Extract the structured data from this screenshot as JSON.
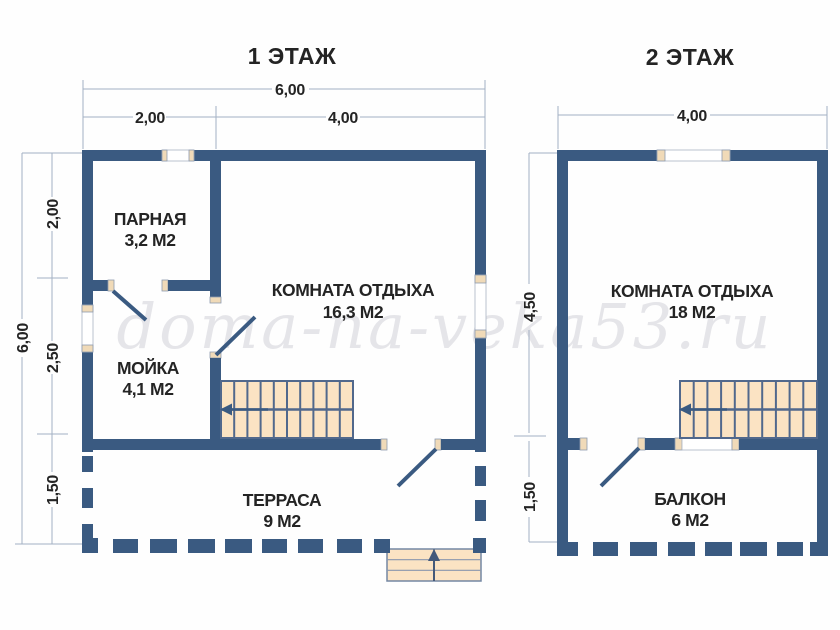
{
  "page": {
    "background": "#fefefe"
  },
  "colors": {
    "wall": "#3a5a81",
    "stair_tread": "#fbe3c3",
    "window_jamb": "#f0dab8",
    "dimension_line": "#a3b0c4",
    "label_text": "#242424",
    "watermark": "#e5e5e9"
  },
  "icons": {
    "stairs_direction": "left-arrow",
    "entrance_direction": "up-arrow"
  },
  "watermark": {
    "text": "doma-na-veka53.ru"
  },
  "floor1": {
    "title": "1 ЭТАЖ",
    "dimensions": {
      "width_total": "6,00",
      "width_left": "2,00",
      "width_right": "4,00",
      "height_total": "6,00",
      "height_top": "2,00",
      "height_middle": "2,50",
      "height_bottom": "1,50"
    },
    "rooms": [
      {
        "name": "ПАРНАЯ",
        "area": "3,2 М2"
      },
      {
        "name": "КОМНАТА ОТДЫХА",
        "area": "16,3 М2"
      },
      {
        "name": "МОЙКА",
        "area": "4,1 М2"
      },
      {
        "name": "ТЕРРАСА",
        "area": "9 М2"
      }
    ]
  },
  "floor2": {
    "title": "2 ЭТАЖ",
    "dimensions": {
      "width_total": "4,00",
      "height_top": "4,50",
      "height_bottom": "1,50"
    },
    "rooms": [
      {
        "name": "КОМНАТА ОТДЫХА",
        "area": "18 М2"
      },
      {
        "name": "БАЛКОН",
        "area": "6 М2"
      }
    ]
  }
}
